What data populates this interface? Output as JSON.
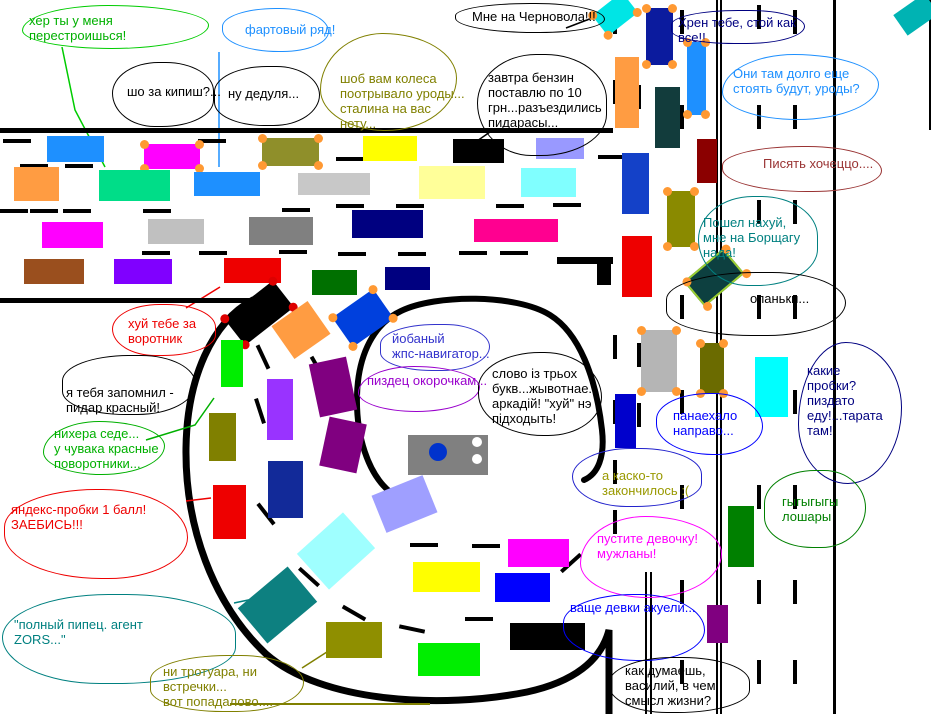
{
  "palette": {
    "background": "#ffffff",
    "road": "#000000",
    "wheel_orange": "#ff9933"
  },
  "bubbles": [
    {
      "lines": [
        "хер ты у меня",
        "перестроишься!"
      ],
      "color": "#00b000",
      "text": {
        "x": 29,
        "y": 13
      },
      "outline": {
        "x": 22,
        "y": 5,
        "w": 185,
        "h": 42,
        "color": "#00cc00"
      }
    },
    {
      "lines": [
        "фартовый ряд!"
      ],
      "color": "#1e90ff",
      "text": {
        "x": 245,
        "y": 22
      },
      "outline": {
        "x": 222,
        "y": 8,
        "w": 105,
        "h": 42,
        "color": "#1e90ff"
      }
    },
    {
      "lines": [
        "шо за кипиш?..."
      ],
      "color": "#000000",
      "text": {
        "x": 127,
        "y": 84
      },
      "outline": {
        "x": 112,
        "y": 62,
        "w": 100,
        "h": 63,
        "color": "#000000"
      }
    },
    {
      "lines": [
        "ну дедуля..."
      ],
      "color": "#000000",
      "text": {
        "x": 228,
        "y": 86
      },
      "outline": {
        "x": 214,
        "y": 66,
        "w": 104,
        "h": 58,
        "color": "#000000"
      }
    },
    {
      "lines": [
        "шоб вам колеса",
        "поотрывало уроды...",
        "сталина на вас",
        "нету..."
      ],
      "color": "#808000",
      "text": {
        "x": 340,
        "y": 71
      },
      "outline": {
        "x": 320,
        "y": 33,
        "w": 135,
        "h": 96,
        "color": "#808000"
      }
    },
    {
      "lines": [
        "Мне на Черновола!!!"
      ],
      "color": "#000000",
      "text": {
        "x": 472,
        "y": 9
      },
      "outline": {
        "x": 455,
        "y": 3,
        "w": 148,
        "h": 28,
        "color": "#000000"
      }
    },
    {
      "lines": [
        "завтра бензин",
        "поставлю по 10",
        "грн...разъездились",
        "пидарасы..."
      ],
      "color": "#000000",
      "text": {
        "x": 488,
        "y": 70
      },
      "outline": {
        "x": 477,
        "y": 54,
        "w": 128,
        "h": 100,
        "color": "#000000"
      }
    },
    {
      "lines": [
        "Хрен тебе, стой как",
        "все!!"
      ],
      "color": "#000080",
      "text": {
        "x": 678,
        "y": 15
      },
      "outline": {
        "x": 671,
        "y": 10,
        "w": 132,
        "h": 32,
        "color": "#000080"
      }
    },
    {
      "lines": [
        "Они там долго еще",
        "стоять будут, уроды?"
      ],
      "color": "#1e90ff",
      "text": {
        "x": 733,
        "y": 66
      },
      "outline": {
        "x": 722,
        "y": 54,
        "w": 155,
        "h": 64,
        "color": "#1e90ff"
      }
    },
    {
      "lines": [
        "Писять хочеццо...."
      ],
      "color": "#993333",
      "text": {
        "x": 763,
        "y": 156
      },
      "outline": {
        "x": 722,
        "y": 146,
        "w": 158,
        "h": 44,
        "color": "#993333"
      }
    },
    {
      "lines": [
        "Пошел нахуй,",
        "мне на Борщагу",
        "нада!"
      ],
      "color": "#008080",
      "text": {
        "x": 703,
        "y": 215
      },
      "outline": {
        "x": 698,
        "y": 196,
        "w": 118,
        "h": 88,
        "color": "#008080"
      }
    },
    {
      "lines": [
        "опаньки..."
      ],
      "color": "#000000",
      "text": {
        "x": 750,
        "y": 291
      },
      "outline": {
        "x": 666,
        "y": 272,
        "w": 178,
        "h": 62,
        "color": "#000000"
      }
    },
    {
      "lines": [
        "какие",
        "пробки?",
        "пиздато",
        "еду!...тарата",
        "там!"
      ],
      "color": "#000080",
      "text": {
        "x": 807,
        "y": 363
      },
      "outline": {
        "x": 798,
        "y": 342,
        "w": 102,
        "h": 140,
        "color": "#000080"
      }
    },
    {
      "lines": [
        "панаехало",
        "направо..."
      ],
      "color": "#0000ff",
      "text": {
        "x": 673,
        "y": 408
      },
      "outline": {
        "x": 656,
        "y": 393,
        "w": 105,
        "h": 60,
        "color": "#0000ff"
      }
    },
    {
      "lines": [
        "а каско-то",
        "закончилось :("
      ],
      "color": "#999900",
      "text": {
        "x": 602,
        "y": 468
      },
      "outline": {
        "x": 572,
        "y": 448,
        "w": 128,
        "h": 57,
        "color": "#2222cc"
      }
    },
    {
      "lines": [
        "гыгыгыгы",
        "лошары"
      ],
      "color": "#008000",
      "text": {
        "x": 782,
        "y": 494
      },
      "outline": {
        "x": 764,
        "y": 470,
        "w": 100,
        "h": 76,
        "color": "#008000"
      }
    },
    {
      "lines": [
        "пустите девочку!",
        "мужланы!"
      ],
      "color": "#ff00ff",
      "text": {
        "x": 597,
        "y": 531
      },
      "outline": {
        "x": 580,
        "y": 516,
        "w": 140,
        "h": 80,
        "color": "#ff00ff"
      }
    },
    {
      "lines": [
        "ваще девки акуели..."
      ],
      "color": "#0000ff",
      "text": {
        "x": 570,
        "y": 600
      },
      "outline": {
        "x": 563,
        "y": 594,
        "w": 140,
        "h": 65,
        "color": "#0000ff"
      }
    },
    {
      "lines": [
        "как думаешь,",
        "василий, в чем",
        "смысл жизни?"
      ],
      "color": "#000000",
      "text": {
        "x": 625,
        "y": 663
      },
      "outline": {
        "x": 608,
        "y": 657,
        "w": 140,
        "h": 54,
        "color": "#000000"
      }
    },
    {
      "lines": [
        "йобаный",
        "жпс-навигатор..."
      ],
      "color": "#3333cc",
      "text": {
        "x": 392,
        "y": 331
      },
      "outline": {
        "x": 380,
        "y": 324,
        "w": 108,
        "h": 45,
        "color": "#3333cc"
      }
    },
    {
      "lines": [
        "пиздец окорочкам..."
      ],
      "color": "#9900cc",
      "text": {
        "x": 367,
        "y": 373
      },
      "outline": {
        "x": 358,
        "y": 366,
        "w": 120,
        "h": 44,
        "color": "#9900cc"
      }
    },
    {
      "lines": [
        "слово із трьох",
        "букв...жывотнае...",
        "аркадій! \"хуй\" нэ",
        "підходыть!"
      ],
      "color": "#000000",
      "text": {
        "x": 492,
        "y": 366
      },
      "outline": {
        "x": 478,
        "y": 352,
        "w": 122,
        "h": 82,
        "color": "#000000"
      }
    },
    {
      "lines": [
        "хуй тебе за",
        "воротник"
      ],
      "color": "#ee0000",
      "text": {
        "x": 128,
        "y": 316
      },
      "outline": {
        "x": 112,
        "y": 304,
        "w": 102,
        "h": 50,
        "color": "#ee0000"
      }
    },
    {
      "lines": [
        "я тебя запомнил -",
        "пидар красный!"
      ],
      "color": "#000000",
      "text": {
        "x": 66,
        "y": 385
      },
      "outline": {
        "x": 62,
        "y": 355,
        "w": 132,
        "h": 58,
        "color": "#000000"
      }
    },
    {
      "lines": [
        "нихера седе...",
        "у чувака красные",
        "поворотники..."
      ],
      "color": "#00b000",
      "text": {
        "x": 54,
        "y": 426
      },
      "outline": {
        "x": 43,
        "y": 421,
        "w": 120,
        "h": 52,
        "color": "#00b000"
      }
    },
    {
      "lines": [
        "яндекс-пробки 1 балл!",
        "ЗАЕБИСЬ!!!"
      ],
      "color": "#ee0000",
      "text": {
        "x": 11,
        "y": 502
      },
      "outline": {
        "x": 4,
        "y": 489,
        "w": 182,
        "h": 88,
        "color": "#ee0000"
      }
    },
    {
      "lines": [
        "\"полный пипец. агент",
        "ZORS...\""
      ],
      "color": "#008080",
      "text": {
        "x": 14,
        "y": 617
      },
      "outline": {
        "x": 2,
        "y": 594,
        "w": 232,
        "h": 88,
        "color": "#008080"
      }
    },
    {
      "lines": [
        "ни тротуара, ни",
        "встречки...",
        "вот попадалово...."
      ],
      "color": "#808000",
      "text": {
        "x": 163,
        "y": 664
      },
      "outline": {
        "x": 150,
        "y": 655,
        "w": 152,
        "h": 55,
        "color": "#808000"
      }
    }
  ],
  "cars": [
    {
      "x": 47,
      "y": 136,
      "w": 57,
      "h": 26,
      "color": "#1e90ff"
    },
    {
      "x": 144,
      "y": 144,
      "w": 56,
      "h": 25,
      "color": "#ff00ff",
      "wheels": "#ff9933"
    },
    {
      "x": 262,
      "y": 138,
      "w": 57,
      "h": 28,
      "color": "#8f8f2a",
      "wheels": "#ff9933"
    },
    {
      "x": 14,
      "y": 167,
      "w": 45,
      "h": 34,
      "color": "#ff9c42"
    },
    {
      "x": 99,
      "y": 170,
      "w": 71,
      "h": 31,
      "color": "#00dd88"
    },
    {
      "x": 194,
      "y": 172,
      "w": 66,
      "h": 24,
      "color": "#1e90ff"
    },
    {
      "x": 298,
      "y": 173,
      "w": 72,
      "h": 22,
      "color": "#c8c8c8"
    },
    {
      "x": 42,
      "y": 222,
      "w": 61,
      "h": 26,
      "color": "#ff00ff"
    },
    {
      "x": 148,
      "y": 219,
      "w": 56,
      "h": 25,
      "color": "#c0c0c0"
    },
    {
      "x": 249,
      "y": 217,
      "w": 64,
      "h": 28,
      "color": "#808080"
    },
    {
      "x": 24,
      "y": 259,
      "w": 60,
      "h": 25,
      "color": "#9a4f1e"
    },
    {
      "x": 114,
      "y": 259,
      "w": 58,
      "h": 25,
      "color": "#8000ff"
    },
    {
      "x": 224,
      "y": 258,
      "w": 57,
      "h": 25,
      "color": "#ee0000"
    },
    {
      "x": 363,
      "y": 136,
      "w": 54,
      "h": 25,
      "color": "#ffff00"
    },
    {
      "x": 453,
      "y": 139,
      "w": 51,
      "h": 24,
      "color": "#000000"
    },
    {
      "x": 536,
      "y": 138,
      "w": 48,
      "h": 21,
      "color": "#9999ff"
    },
    {
      "x": 419,
      "y": 166,
      "w": 66,
      "h": 33,
      "color": "#ffff99"
    },
    {
      "x": 521,
      "y": 168,
      "w": 55,
      "h": 29,
      "color": "#80ffff"
    },
    {
      "x": 352,
      "y": 210,
      "w": 71,
      "h": 28,
      "color": "#000080"
    },
    {
      "x": 474,
      "y": 219,
      "w": 84,
      "h": 23,
      "color": "#ff0090"
    },
    {
      "x": 312,
      "y": 270,
      "w": 45,
      "h": 25,
      "color": "#007000"
    },
    {
      "x": 385,
      "y": 267,
      "w": 45,
      "h": 23,
      "color": "#000080"
    },
    {
      "x": 228,
      "y": 296,
      "w": 62,
      "h": 34,
      "color": "#000000",
      "rot": -38,
      "wheels": "#dd0000"
    },
    {
      "x": 279,
      "y": 310,
      "w": 44,
      "h": 40,
      "color": "#ff9c42",
      "rot": -35
    },
    {
      "x": 338,
      "y": 300,
      "w": 50,
      "h": 36,
      "color": "#0040dd",
      "rot": -35,
      "wheels": "#ff9933"
    },
    {
      "x": 221,
      "y": 340,
      "w": 22,
      "h": 47,
      "color": "#00ee00"
    },
    {
      "x": 267,
      "y": 379,
      "w": 26,
      "h": 61,
      "color": "#9933ff"
    },
    {
      "x": 314,
      "y": 360,
      "w": 38,
      "h": 54,
      "color": "#800080",
      "rot": -12
    },
    {
      "x": 324,
      "y": 420,
      "w": 38,
      "h": 50,
      "color": "#800080",
      "rot": 12
    },
    {
      "x": 209,
      "y": 413,
      "w": 27,
      "h": 48,
      "color": "#808000"
    },
    {
      "x": 268,
      "y": 461,
      "w": 35,
      "h": 57,
      "color": "#122a99"
    },
    {
      "x": 213,
      "y": 485,
      "w": 33,
      "h": 54,
      "color": "#ee0000"
    },
    {
      "x": 377,
      "y": 484,
      "w": 55,
      "h": 40,
      "color": "#9f9fff",
      "rot": -22
    },
    {
      "x": 305,
      "y": 527,
      "w": 62,
      "h": 48,
      "color": "#9fffff",
      "rot": -42
    },
    {
      "x": 245,
      "y": 582,
      "w": 65,
      "h": 46,
      "color": "#0d8080",
      "rot": -40
    },
    {
      "x": 326,
      "y": 622,
      "w": 56,
      "h": 36,
      "color": "#8f8f00"
    },
    {
      "x": 413,
      "y": 562,
      "w": 67,
      "h": 30,
      "color": "#ffff00"
    },
    {
      "x": 418,
      "y": 643,
      "w": 62,
      "h": 33,
      "color": "#00ee00"
    },
    {
      "x": 508,
      "y": 539,
      "w": 61,
      "h": 28,
      "color": "#ff00ff"
    },
    {
      "x": 495,
      "y": 573,
      "w": 55,
      "h": 29,
      "color": "#0000ff"
    },
    {
      "x": 510,
      "y": 623,
      "w": 75,
      "h": 27,
      "color": "#000000"
    },
    {
      "x": 596,
      "y": 1,
      "w": 38,
      "h": 26,
      "color": "#00e5e5",
      "rot": -38,
      "wheels": "#ff9933"
    },
    {
      "x": 646,
      "y": 8,
      "w": 27,
      "h": 57,
      "color": "#0b1b9e",
      "wheels": "#ff9933"
    },
    {
      "x": 615,
      "y": 57,
      "w": 24,
      "h": 71,
      "color": "#ff9c42"
    },
    {
      "x": 655,
      "y": 87,
      "w": 25,
      "h": 61,
      "color": "#123c3c"
    },
    {
      "x": 687,
      "y": 42,
      "w": 19,
      "h": 73,
      "color": "#1e90ff",
      "wheels": "#ff9933"
    },
    {
      "x": 622,
      "y": 153,
      "w": 27,
      "h": 61,
      "color": "#1441c8"
    },
    {
      "x": 697,
      "y": 139,
      "w": 20,
      "h": 44,
      "color": "#8b0000"
    },
    {
      "x": 667,
      "y": 191,
      "w": 28,
      "h": 56,
      "color": "#8a8a00",
      "wheels": "#ff9933"
    },
    {
      "x": 622,
      "y": 236,
      "w": 30,
      "h": 61,
      "color": "#ee0000"
    },
    {
      "x": 688,
      "y": 261,
      "w": 52,
      "h": 33,
      "color": "#0d4040",
      "rot": -40,
      "wheels": "#ff9933",
      "border": "#9acd32"
    },
    {
      "x": 897,
      "y": 2,
      "w": 38,
      "h": 25,
      "color": "#00b3b3",
      "rot": -35
    },
    {
      "x": 641,
      "y": 330,
      "w": 36,
      "h": 62,
      "color": "#b5b5b5",
      "wheels": "#ff9933"
    },
    {
      "x": 700,
      "y": 343,
      "w": 24,
      "h": 51,
      "color": "#6b6b00",
      "wheels": "#ff9933"
    },
    {
      "x": 615,
      "y": 394,
      "w": 21,
      "h": 54,
      "color": "#0000cc"
    },
    {
      "x": 755,
      "y": 357,
      "w": 33,
      "h": 60,
      "color": "#00ffff"
    },
    {
      "x": 728,
      "y": 506,
      "w": 26,
      "h": 61,
      "color": "#008000"
    },
    {
      "x": 707,
      "y": 605,
      "w": 21,
      "h": 38,
      "color": "#800080"
    },
    {
      "x": 408,
      "y": 435,
      "w": 80,
      "h": 40,
      "color": "#808080",
      "dots": [
        {
          "dx": 30,
          "dy": 17,
          "r": 9,
          "color": "#0033cc"
        },
        {
          "dx": 69,
          "dy": 7,
          "r": 5,
          "color": "#ffffff"
        },
        {
          "dx": 69,
          "dy": 24,
          "r": 5,
          "color": "#ffffff"
        }
      ]
    }
  ]
}
